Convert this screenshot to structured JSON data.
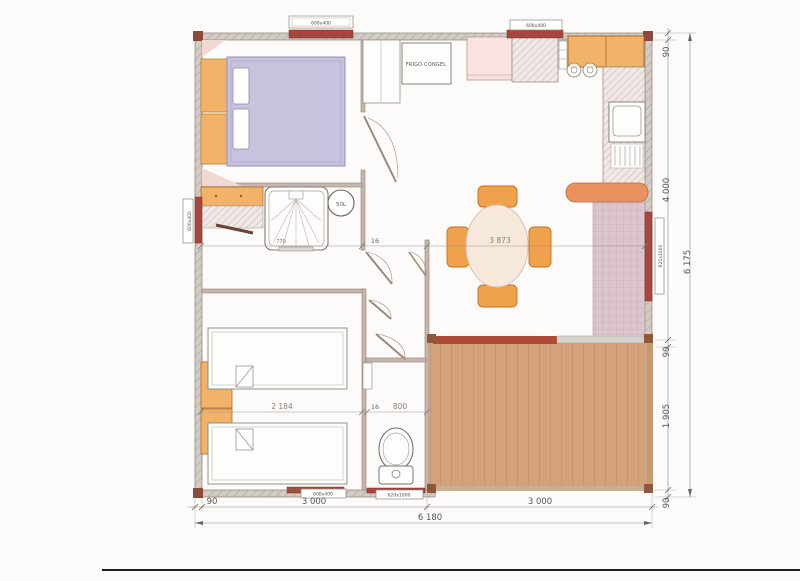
{
  "labels": {
    "fridge": "FRIGO CONGEL",
    "water_heater": "50L"
  },
  "window_labels": {
    "top_bedroom": "600x400",
    "top_kitchen": "600x400",
    "left_bathroom": "600x400",
    "right_living": "620x1000",
    "bottom_bedroom": "600x400",
    "bottom_wc": "620x1000"
  },
  "dimensions": {
    "right_segments": [
      "90",
      "4 000",
      "90",
      "1 905",
      "90"
    ],
    "right_total": "6 175",
    "bottom_segment_small": "90",
    "bottom_segment_left": "3 000",
    "bottom_segment_right": "3 000",
    "bottom_total": "6 180",
    "interior_shower": "770",
    "interior_wall": "16",
    "interior_living": "3 873",
    "bedroom2_width": "2 184",
    "bedroom2_wall": "16",
    "wc_width": "800"
  },
  "palette": {
    "wall_hatch": "#d3ccc4",
    "window_band": "#a8463e",
    "furniture_orange": "#f2b368",
    "chair_orange": "#f0a14b",
    "bed_lavender": "#c6c3de",
    "table_cream": "#f6e9dc",
    "deck_wood": "#d4a27a",
    "deck_edge_red": "#b04a38",
    "seat_pink": "#dcc6ce",
    "sofa_back": "#e8935f",
    "dim_text": "#555555"
  }
}
